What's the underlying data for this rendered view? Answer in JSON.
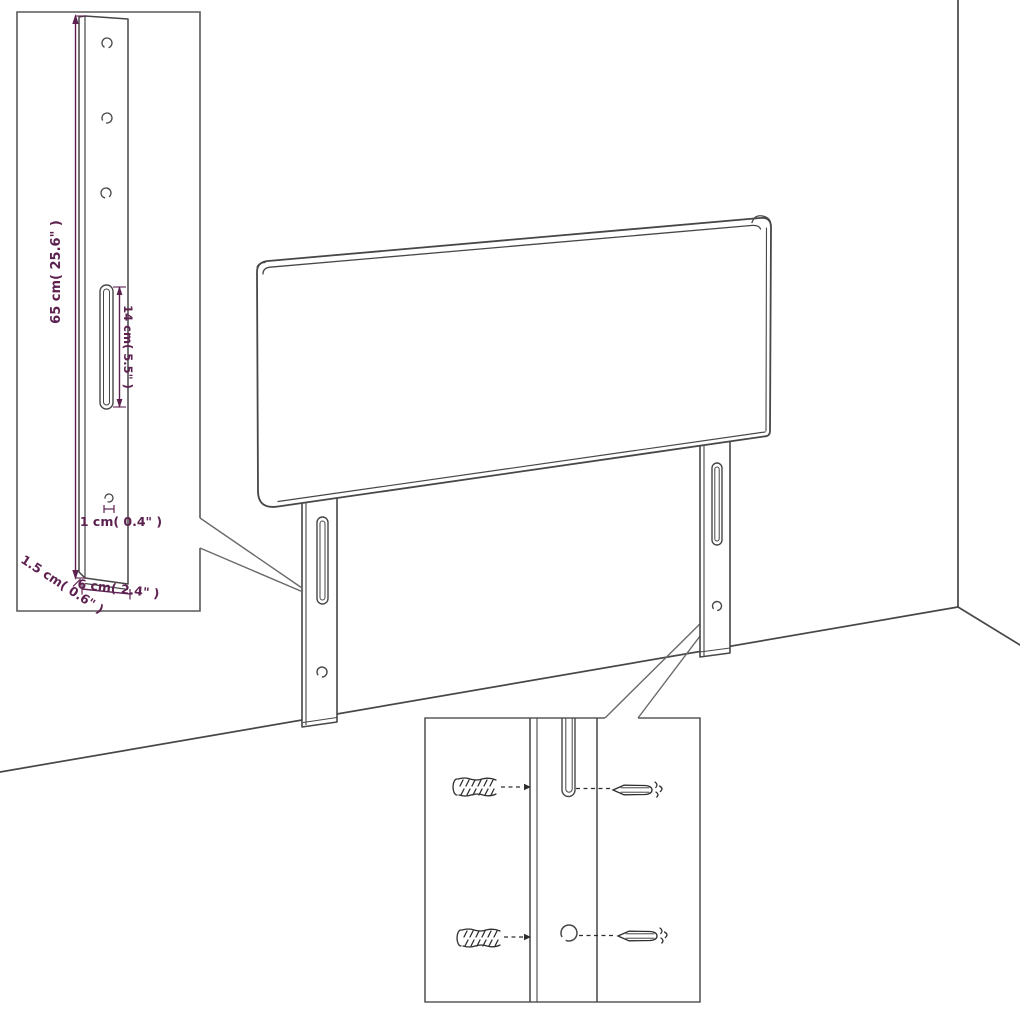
{
  "diagram": {
    "type": "furniture-assembly-dimension-diagram",
    "subject": "headboard with mounting legs against wall corner",
    "colors": {
      "background": "#ffffff",
      "line": "#474747",
      "sketch": "#2e2e2e",
      "dimension": "#5d2150"
    },
    "insets": {
      "leg_detail": {
        "labels": {
          "height": "65 cm( 25.6\" )",
          "slot_length": "14 cm( 5.5\" )",
          "hole_diameter": "1 cm( 0.4\" )",
          "thickness": "1.5 cm( 0.6\" )",
          "width": "6 cm( 2.4\" )"
        }
      },
      "mounting_detail": {
        "hardware": [
          "wall-plug",
          "wall-plug",
          "screw",
          "screw"
        ]
      }
    }
  }
}
